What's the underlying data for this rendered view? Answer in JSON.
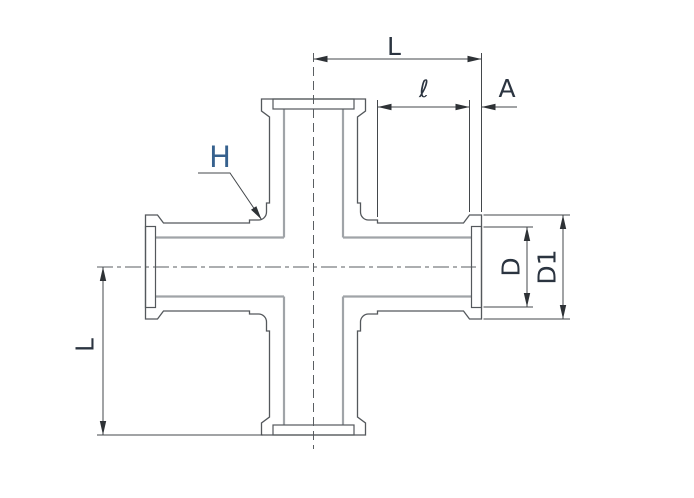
{
  "drawing": {
    "type": "technical-drawing",
    "subject": "4-way cross pipe fitting, front view with dimensions"
  },
  "labels": {
    "length_top": "L",
    "socket_depth": "ℓ",
    "flange_thickness": "A",
    "weld_ref": "H",
    "diameter_inner": "D",
    "diameter_flange": "D1",
    "length_left": "L"
  },
  "colors": {
    "background": "#ffffff",
    "outline": "#54585c",
    "bore_line": "#a0a4a8",
    "dimension_line": "#43474b",
    "arrow_fill": "#2e3236",
    "centerline": "#5a5e62",
    "label_text": "#2b3440",
    "h_label_text": "#36618e"
  },
  "geometry": {
    "cx": 313.5,
    "cy": 267,
    "faceU": 168,
    "plateBackU": 156,
    "plateHalf": 52,
    "chamferU": 150,
    "mainHalf": 44,
    "stepU": 64,
    "collarHalf": 47,
    "filletStartU": 55,
    "filletR": 8,
    "boreHalf": 29.5,
    "recessDepth": 10,
    "recessHalf": 40.5,
    "centerline_v": {
      "x": 313.5,
      "y1": 53,
      "y2": 449,
      "dash": "9 5"
    },
    "centerline_h": {
      "y": 267,
      "x1": 97,
      "x2": 476,
      "dash": "16 4 4 4"
    },
    "dim_L_top": {
      "x1": 313.5,
      "y": 59,
      "x2": 481.5
    },
    "dim_ell": {
      "x1": 377.5,
      "y": 107,
      "x2": 469.5
    },
    "dim_A": {
      "x1": 481.5,
      "y": 107,
      "x2": 517
    },
    "dim_L_left": {
      "x": 103,
      "y1": 267,
      "y2": 435
    },
    "dim_D": {
      "x": 527,
      "y1": 227,
      "y2": 307
    },
    "dim_D1": {
      "x": 563,
      "y1": 215,
      "y2": 319
    },
    "ext_lines": [
      [
        481.5,
        53,
        481.5,
        212
      ],
      [
        469.5,
        100,
        469.5,
        212
      ],
      [
        377.5,
        100,
        377.5,
        217
      ],
      [
        97,
        435,
        263,
        435
      ],
      [
        483.5,
        227,
        533,
        227
      ],
      [
        483.5,
        307,
        533,
        307
      ],
      [
        483.5,
        215,
        570,
        215
      ],
      [
        483.5,
        319,
        570,
        319
      ]
    ],
    "h_leader": {
      "points": [
        [
          198,
          173
        ],
        [
          230,
          173
        ],
        [
          261.5,
          219.5
        ]
      ]
    }
  }
}
